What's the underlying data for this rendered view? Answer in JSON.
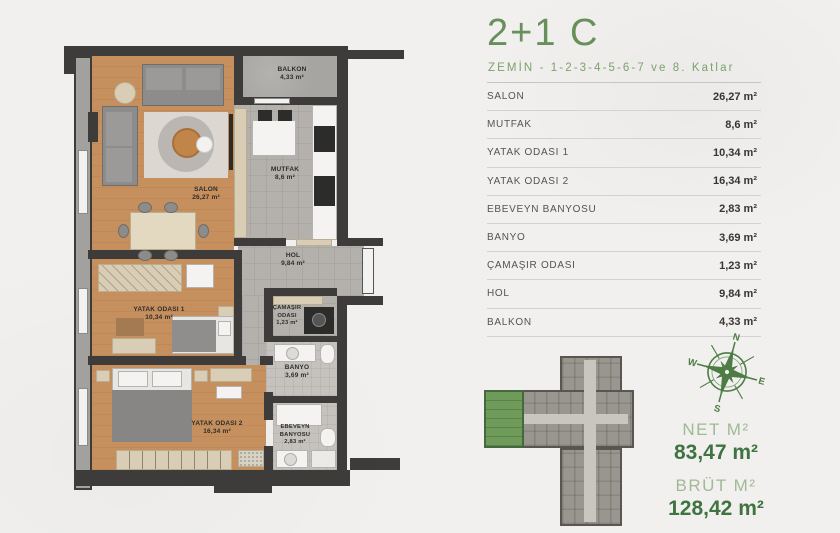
{
  "header": {
    "title": "2+1 C",
    "subtitle": "ZEMİN - 1-2-3-4-5-6-7 ve 8. Katlar"
  },
  "table": {
    "rows": [
      {
        "label": "SALON",
        "value": "26,27 m²"
      },
      {
        "label": "MUTFAK",
        "value": "8,6 m²"
      },
      {
        "label": "YATAK ODASI 1",
        "value": "10,34 m²"
      },
      {
        "label": "YATAK ODASI 2",
        "value": "16,34 m²"
      },
      {
        "label": "EBEVEYN BANYOSU",
        "value": "2,83 m²"
      },
      {
        "label": "BANYO",
        "value": "3,69 m²"
      },
      {
        "label": "ÇAMAŞIR ODASI",
        "value": "1,23 m²"
      },
      {
        "label": "HOL",
        "value": "9,84 m²"
      },
      {
        "label": "BALKON",
        "value": "4,33 m²"
      }
    ]
  },
  "plan": {
    "rooms": [
      {
        "name": "SALON",
        "area": "26,27 m²"
      },
      {
        "name": "MUTFAK",
        "area": "8,6 m²"
      },
      {
        "name": "BALKON",
        "area": "4,33 m²"
      },
      {
        "name": "HOL",
        "area": "9,84 m²"
      },
      {
        "name": "ÇAMAŞIR ODASI",
        "area": "1,23 m²"
      },
      {
        "name": "BANYO",
        "area": "3,69 m²"
      },
      {
        "name": "YATAK ODASI 1",
        "area": "10,34 m²"
      },
      {
        "name": "YATAK ODASI 2",
        "area": "16,34 m²"
      },
      {
        "name": "EBEVEYN BANYOSU",
        "area": "2,83 m²"
      }
    ]
  },
  "compass": {
    "n": "N",
    "e": "E",
    "s": "S",
    "w": "W"
  },
  "areas": {
    "net_label": "NET M²",
    "net_value": "83,47 m²",
    "brut_label": "BRÜT M²",
    "brut_value": "128,42 m²"
  },
  "colors": {
    "accent_green": "#67905b",
    "dark_green": "#3f7340",
    "light_green": "#a0b996",
    "wall": "#3d3c3a",
    "wood_floor": "#c68f5e",
    "keyplan_unit_green": "#6e9b5a"
  }
}
